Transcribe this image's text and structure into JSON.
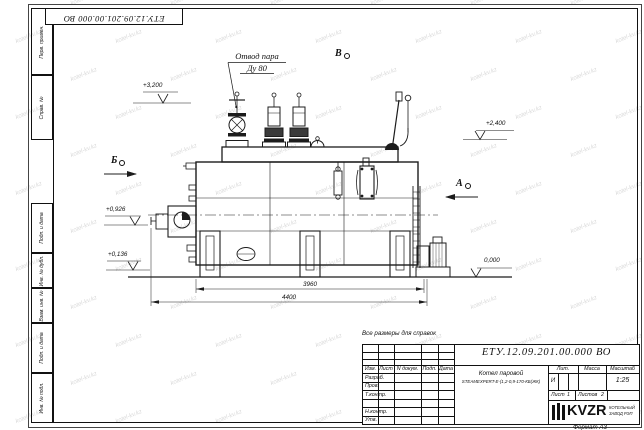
{
  "watermark": {
    "text": "kotel-kv.kz"
  },
  "frame": {
    "top_designation": "ЕТУ.12.09.201.00.000 ВО",
    "left_stamps": [
      "Перв. примен.",
      "Справ. №",
      "Подп. и дата",
      "Инв. № дубл.",
      "Взам. инв. №",
      "Подп. и дата",
      "Инв. № подл."
    ],
    "format_note": "Формат А3"
  },
  "drawing": {
    "note": "Все размеры для справок",
    "callout_line1": "Отвод пара",
    "callout_line2": "Ду 80",
    "view_b": "Б",
    "view_a": "А",
    "view_v": "В",
    "elev_top": "+3,200",
    "elev_burner": "+0,926",
    "elev_low": "+0,136",
    "elev_right": "+2,400",
    "elev_zero": "0,000",
    "dim_inner": "3960",
    "dim_outer": "4400"
  },
  "title_block": {
    "designation": "ЕТУ.12.09.201.00.000 ВО",
    "name_line1": "Котел паровой",
    "name_line2": "STEAMEXPERT-E-(1,2-0,9-170-КБ(ЖК)",
    "col_izm": "Изм.",
    "col_list": "Лист",
    "col_ndokum": "N докум.",
    "col_podp": "Подп.",
    "col_data": "Дата",
    "rows": [
      "Разраб.",
      "Пров.",
      "Т.контр.",
      "",
      "Н.контр.",
      "Утв."
    ],
    "col_lit": "Лит.",
    "col_massa": "Масса",
    "col_masshtab": "Масштаб",
    "lit_value": "И",
    "scale_value": "1:25",
    "sheet_label": "Лист",
    "sheet_value": "1",
    "sheets_label": "Листов",
    "sheets_value": "2",
    "logo_text": "KVZR",
    "logo_sub1": "КОТЕЛЬНЫЙ",
    "logo_sub2": "ЗАВОД РЭП"
  }
}
